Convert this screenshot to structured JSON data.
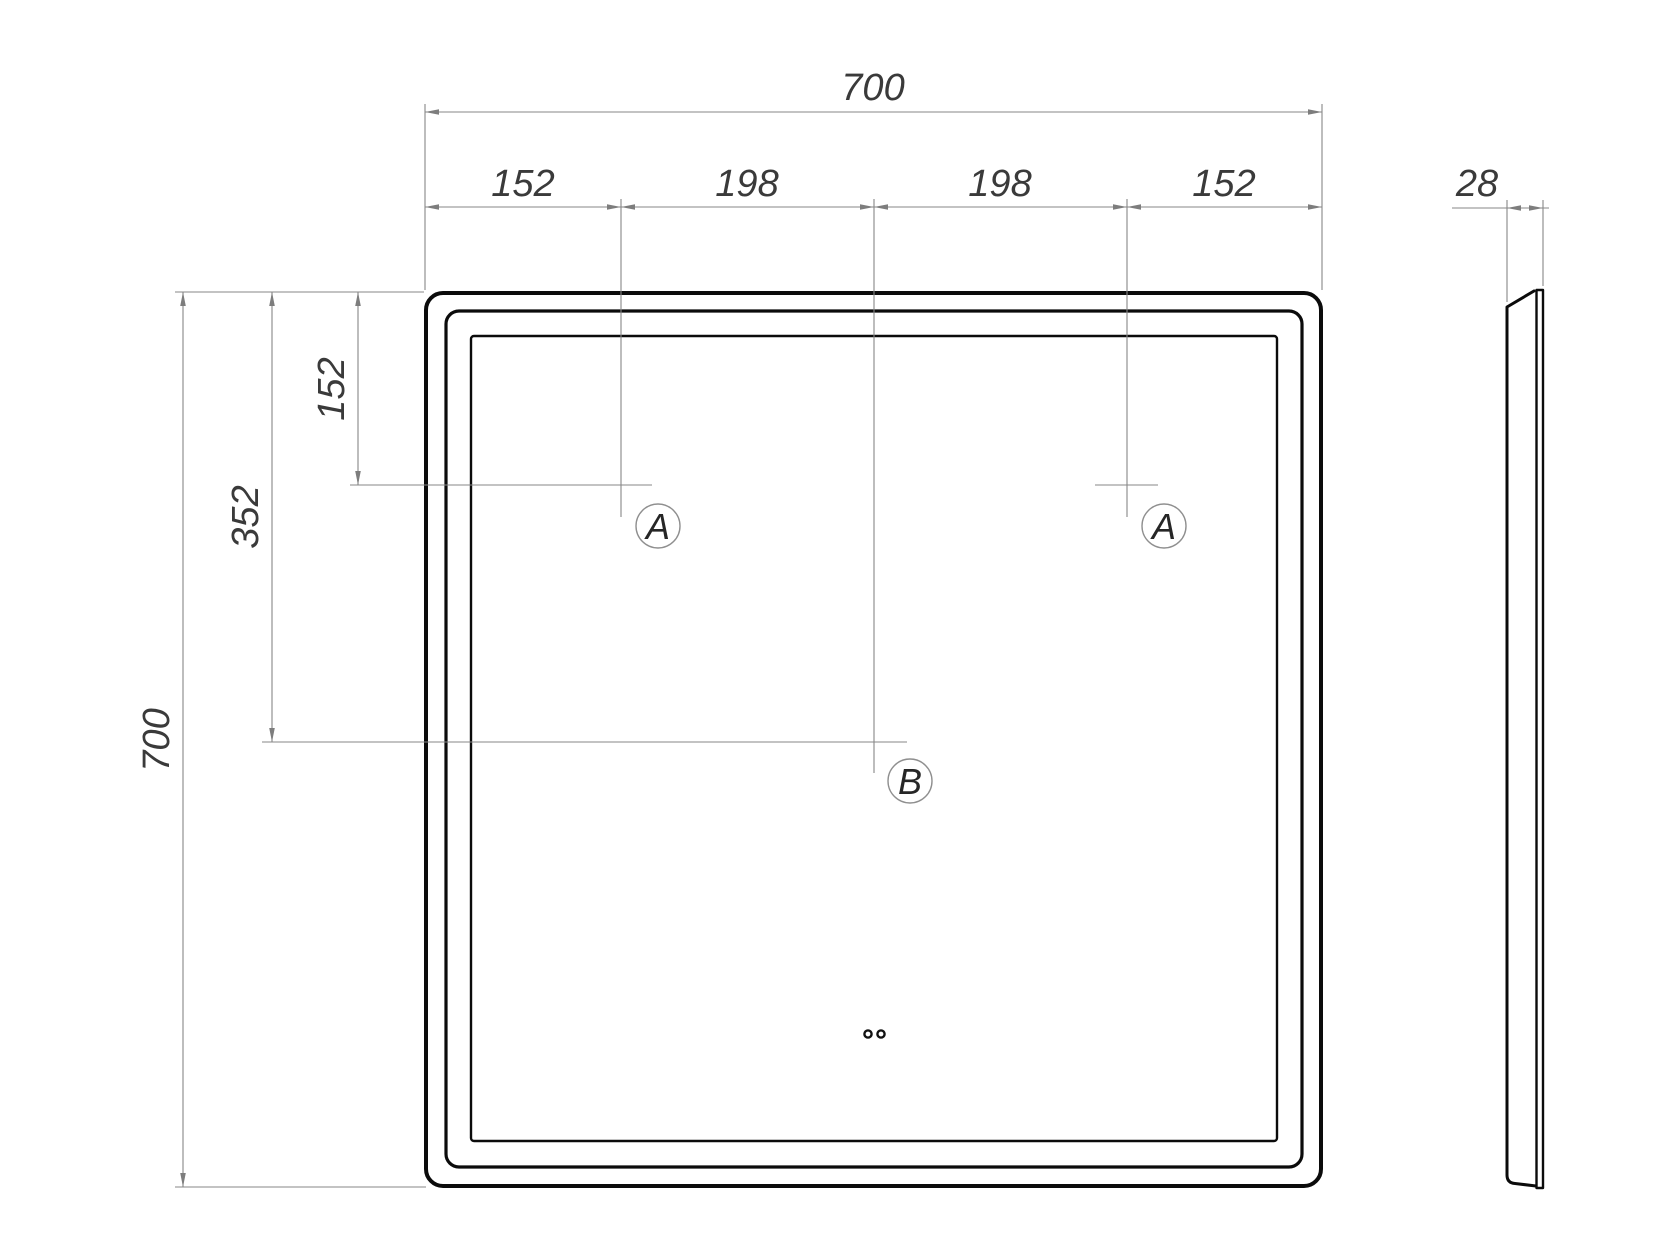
{
  "colors": {
    "background": "#ffffff",
    "outline": "#0b0b0b",
    "dimension_lines": "#878787",
    "dimension_text": "#3a3a3a"
  },
  "front_view": {
    "top_dimension_total": "700",
    "top_dimension_segments": [
      "152",
      "198",
      "198",
      "152"
    ],
    "left_dimension_hole": "152",
    "left_dimension_mid": "352",
    "left_dimension_total": "700",
    "hole_label_left": "A",
    "hole_label_right": "A",
    "hole_label_center": "B"
  },
  "side_view": {
    "thickness_dimension": "28"
  }
}
